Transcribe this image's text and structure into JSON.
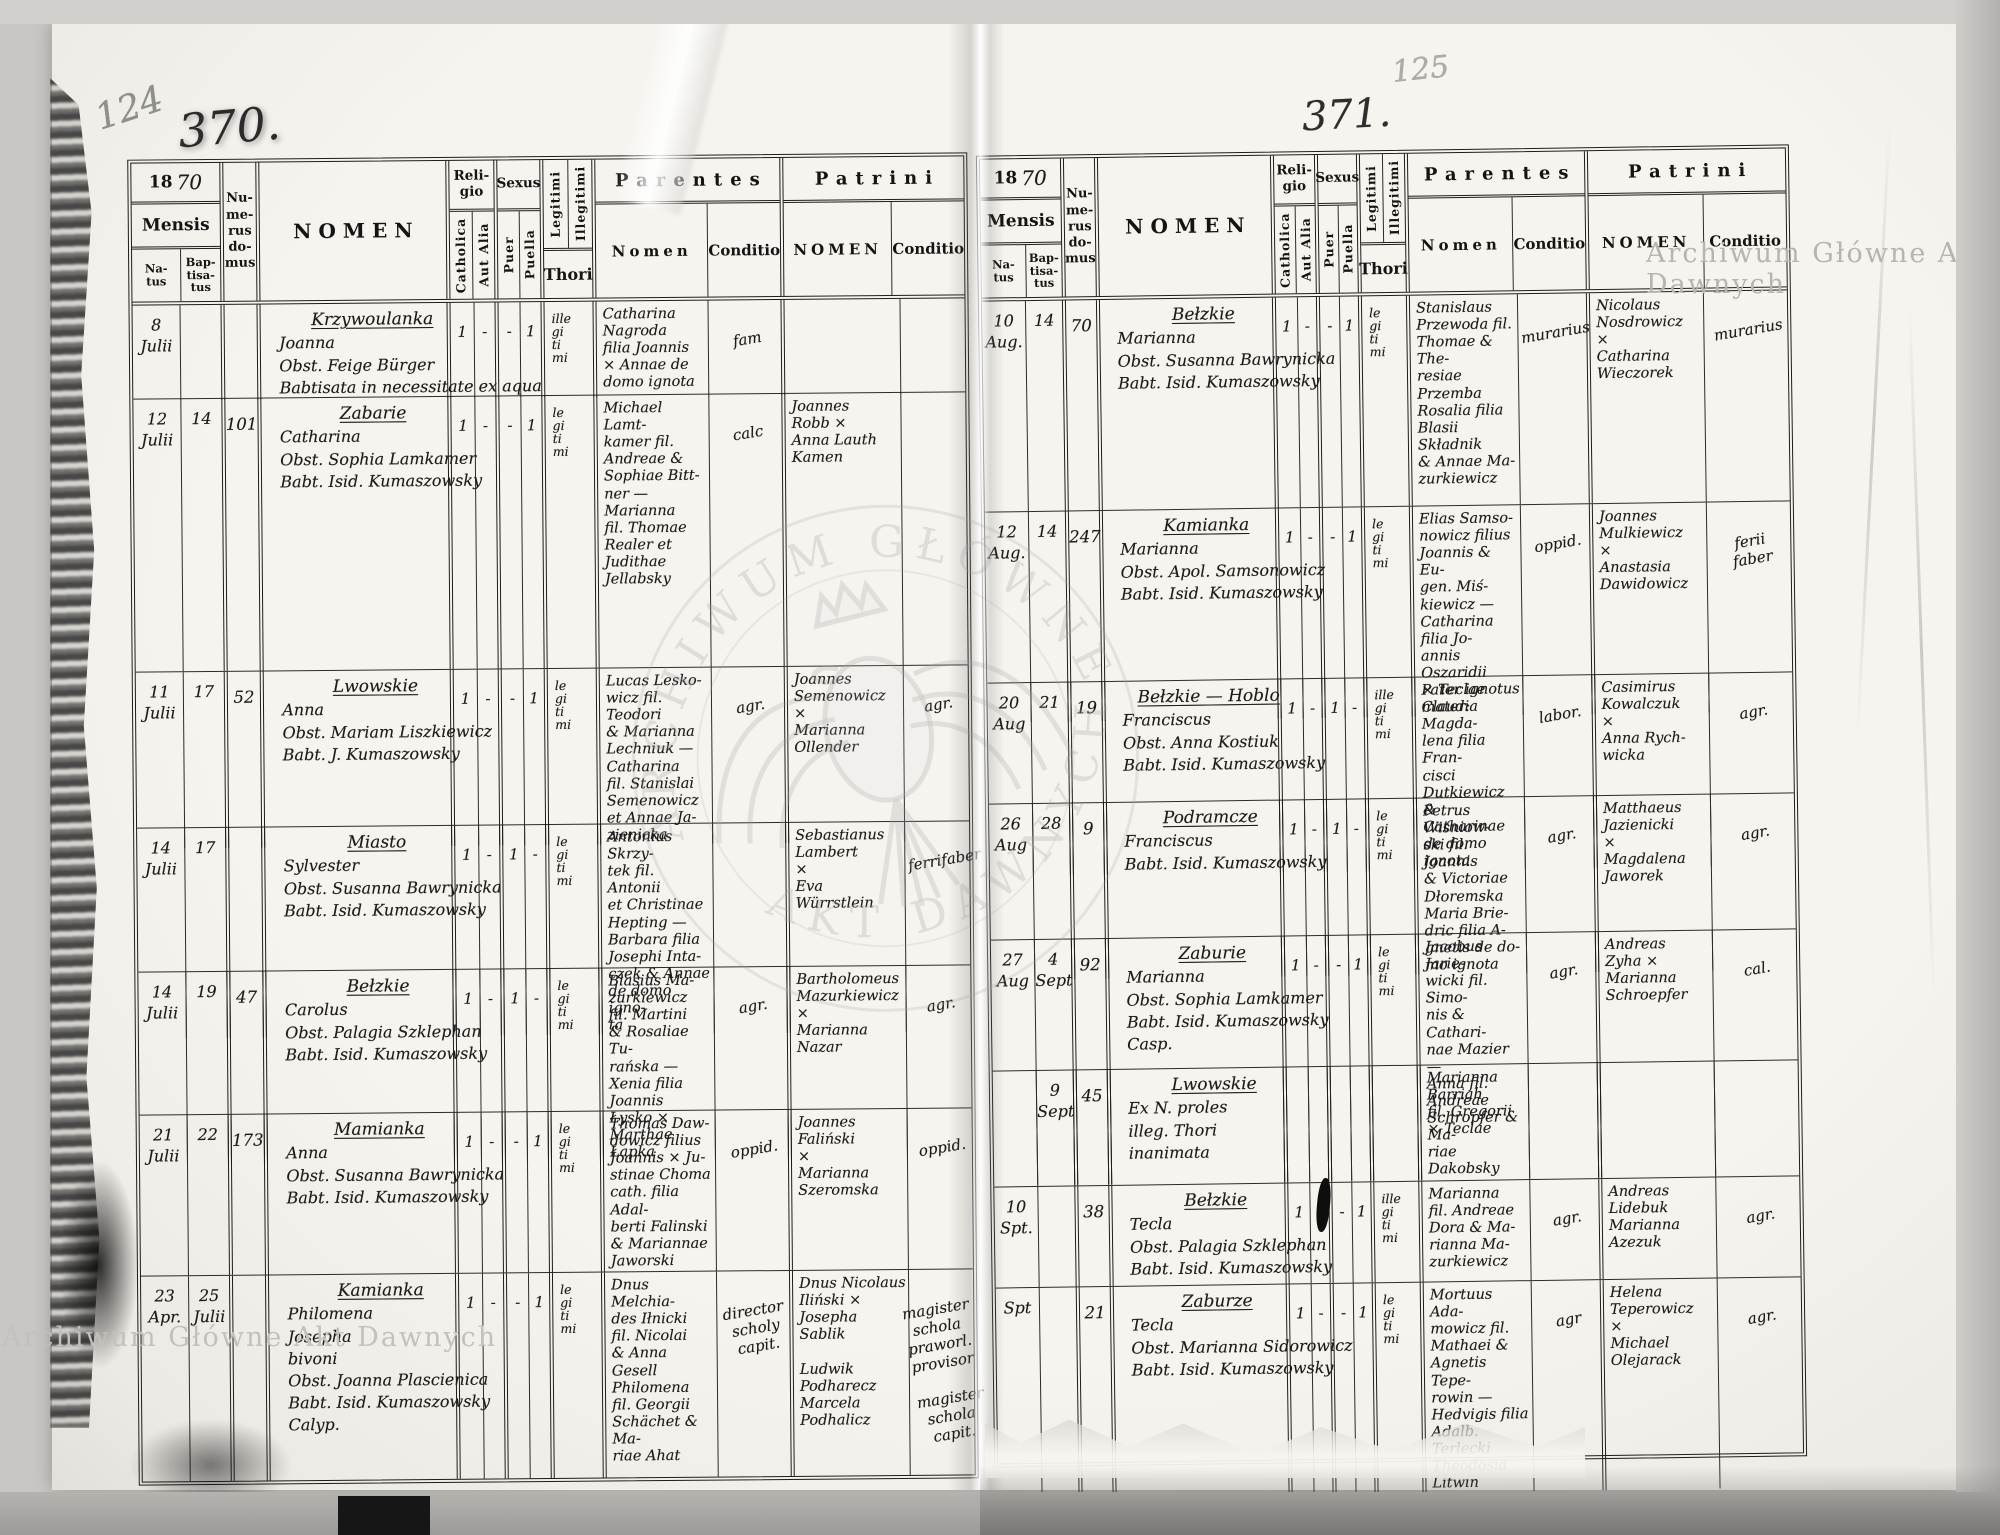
{
  "scan": {
    "watermark_top_right": "Archiwum Główne Akt Dawnych",
    "watermark_bottom_left": "Archiwum Główne Akt Dawnych",
    "stamp_arc_top": "ARCHIWUM GŁÓWNE",
    "stamp_arc_bottom": "AKT DAWNYCH",
    "pencil_folio_left": "124",
    "pencil_folio_right": "125",
    "page_number_left": "370.",
    "page_number_right": "371."
  },
  "header_labels": {
    "year_printed": "18",
    "year_hw": "70",
    "mensis": "Mensis",
    "natus": "Na-\ntus",
    "baptisatus": "Bap-\ntisa-\ntus",
    "numerus": "Nu-\nme-\nrus\ndo-\nmus",
    "nomen": "NOMEN",
    "religio": "Reli-\ngio",
    "catholica": "Catholica",
    "aut_alia": "Aut Alia",
    "sexus": "Sexus",
    "puer": "Puer",
    "puella": "Puella",
    "legitimi": "Legitimi",
    "illegitimi": "Illegitimi",
    "thori": "Thori",
    "parentes": "Parentes",
    "parentes_nomen": "Nomen",
    "parentes_conditio": "Conditio",
    "patrini": "Patrini",
    "patrini_nomen": "NOMEN",
    "patrini_conditio": "Conditio"
  },
  "left_page": {
    "rows": [
      {
        "natus": "8\nJulii",
        "baptisatus": "",
        "numerus": "",
        "nomen": [
          "Krzywoulanka",
          "Joanna",
          "Obst. Feige Bürger",
          "Babtisata in necessitate ex aqua"
        ],
        "catholica": "1",
        "aut_alia": "-",
        "puer": "-",
        "puella": "1",
        "thori": "ille\ngi\nti\nmi",
        "par_nomen": "Catharina\nNagroda\nfilia Joannis\n× Annae de\ndomo ignota",
        "par_conditio": "fam",
        "pat_nomen": "",
        "pat_conditio": ""
      },
      {
        "natus": "12\nJulii",
        "baptisatus": "14",
        "numerus": "101",
        "nomen": [
          "Zabarie",
          "Catharina",
          "Obst. Sophia Lamkamer",
          "Babt. Isid. Kumaszowsky"
        ],
        "catholica": "1",
        "aut_alia": "-",
        "puer": "-",
        "puella": "1",
        "thori": "le\ngi\nti\nmi",
        "par_nomen": "Michael Lamt-\nkamer fil.\nAndreae &\nSophiae Bitt-\nner —\nMarianna\nfil. Thomae\nRealer et\nJudithae\nJellabsky",
        "par_conditio": "calc",
        "pat_nomen": "Joannes\nRobb ×\nAnna Lauth\nKamen",
        "pat_conditio": ""
      },
      {
        "natus": "11\nJulii",
        "baptisatus": "17",
        "numerus": "52",
        "nomen": [
          "Lwowskie",
          "Anna",
          "Obst. Mariam Liszkiewicz",
          "Babt. J. Kumaszowsky"
        ],
        "catholica": "1",
        "aut_alia": "-",
        "puer": "-",
        "puella": "1",
        "thori": "le\ngi\nti\nmi",
        "par_nomen": "Lucas Lesko-\nwicz fil. Teodori\n& Marianna\nLechniuk —\nCatharina\nfil. Stanislai\nSemenowicz\net Annae Ja-\nzienicka",
        "par_conditio": "agr.",
        "pat_nomen": "Joannes\nSemenowicz\n×\nMarianna\nOllender",
        "pat_conditio": "agr."
      },
      {
        "natus": "14\nJulii",
        "baptisatus": "17",
        "numerus": "",
        "nomen": [
          "Miasto",
          "Sylvester",
          "Obst. Susanna Bawrynicka",
          "Babt. Isid. Kumaszowsky"
        ],
        "catholica": "1",
        "aut_alia": "-",
        "puer": "1",
        "puella": "-",
        "thori": "le\ngi\nti\nmi",
        "par_nomen": "Antonius Skrzy-\ntek fil. Antonii\net Christinae\nHepting —\nBarbara filia\nJosephi Inta-\nczek & Annae\nde domo igno-\nta",
        "par_conditio": "",
        "pat_nomen": "Sebastianus\nLambert\n×\nEva Würrstlein",
        "pat_conditio": "ferrifaber"
      },
      {
        "natus": "14\nJulii",
        "baptisatus": "19",
        "numerus": "47",
        "nomen": [
          "Bełzkie",
          "Carolus",
          "Obst. Palagia Szklephan",
          "Babt. Isid. Kumaszowsky"
        ],
        "catholica": "1",
        "aut_alia": "-",
        "puer": "1",
        "puella": "-",
        "thori": "le\ngi\nti\nmi",
        "par_nomen": "Blasius Ma-\nzurkiewicz\nfil. Martini\n& Rosaliae Tu-\nrańska —\nXenia filia Joannis\nŁysko × Marthae\nŁapka",
        "par_conditio": "agr.",
        "pat_nomen": "Bartholomeus\nMazurkiewicz\n×\nMarianna\nNazar",
        "pat_conditio": "agr."
      },
      {
        "natus": "21\nJulii",
        "baptisatus": "22",
        "numerus": "173",
        "nomen": [
          "Mamianka",
          "Anna",
          "Obst. Susanna Bawrynicka",
          "Babt. Isid. Kumaszowsky"
        ],
        "catholica": "1",
        "aut_alia": "-",
        "puer": "-",
        "puella": "1",
        "thori": "le\ngi\nti\nmi",
        "par_nomen": "Thomas Daw-\ndowicz filius\nJoannis × Ju-\nstinae Choma\ncath. filia Adal-\nberti Falinski\n& Mariannae\nJaworski",
        "par_conditio": "oppid.",
        "pat_nomen": "Joannes\nFaliński\n×\nMarianna\nSzeromska",
        "pat_conditio": "oppid."
      },
      {
        "natus": "23\nApr.",
        "baptisatus": "25\nJulii",
        "numerus": "",
        "nomen": [
          "Kamianka",
          "Philomena",
          "Josepha",
          "bivoni",
          "Obst. Joanna Plascienica",
          "Babt. Isid. Kumaszowsky",
          "Calyp."
        ],
        "catholica": "1",
        "aut_alia": "-",
        "puer": "-",
        "puella": "1",
        "thori": "le\ngi\nti\nmi",
        "par_nomen": "Dnus Melchia-\ndes Iłnicki\nfil. Nicolai\n& Anna Gesell\nPhilomena\nfil. Georgii\nSchächet & Ma-\nriae Ahat",
        "par_conditio": "director\nscholy\ncapit.",
        "pat_nomen": "Dnus Nicolaus\nIliński ×\nJosepha Sablik\n\nLudwik\nPodharecz\nMarcela\nPodhalicz",
        "pat_conditio": "magister\nschola\npraworl.\nprovisor\n\nmagister\nschola\ncapit."
      }
    ]
  },
  "right_page": {
    "rows": [
      {
        "natus": "10\nAug.",
        "baptisatus": "14",
        "numerus": "70",
        "nomen": [
          "Bełzkie",
          "Marianna",
          "Obst. Susanna Bawrynicka",
          "Babt. Isid. Kumaszowsky"
        ],
        "catholica": "1",
        "aut_alia": "-",
        "puer": "-",
        "puella": "1",
        "thori": "le\ngi\nti\nmi",
        "par_nomen": "Stanislaus\nPrzewoda fil.\nThomae & The-\nresiae Przemba\nRosalia filia\nBlasii Składnik\n& Annae Ma-\nzurkiewicz",
        "par_conditio": "murarius",
        "pat_nomen": "Nicolaus\nNosdrowicz\n×\nCatharina\nWieczorek",
        "pat_conditio": "murarius"
      },
      {
        "natus": "12\nAug.",
        "baptisatus": "14",
        "numerus": "247",
        "nomen": [
          "Kamianka",
          "Marianna",
          "Obst. Apol. Samsonowicz",
          "Babt. Isid. Kumaszowsky"
        ],
        "catholica": "1",
        "aut_alia": "-",
        "puer": "-",
        "puella": "1",
        "thori": "le\ngi\nti\nmi",
        "par_nomen": "Elias Samso-\nnowicz filius\nJoannis & Eu-\ngen. Miś-\nkiewicz —\nCatharina\nfilia Jo-\nannis Oszaridii\n× Teclae Claudia",
        "par_conditio": "oppid.",
        "pat_nomen": "Joannes\nMulkiewicz\n×\nAnastasia\nDawidowicz",
        "pat_conditio": "ferii\nfaber"
      },
      {
        "natus": "20\nAug",
        "baptisatus": "21",
        "numerus": "19",
        "nomen": [
          "Bełzkie — Hoblo",
          "Franciscus",
          "Obst. Anna Kostiuk",
          "Babt. Isid. Kumaszowsky"
        ],
        "catholica": "1",
        "aut_alia": "-",
        "puer": "1",
        "puella": "-",
        "thori": "ille\ngi\nti\nmi",
        "par_nomen": "Pater ignotus\nmater: Magda-\nlena filia Fran-\ncisci Dutkiewicz\n& Catharinae\nde domo ignota",
        "par_conditio": "labor.",
        "pat_nomen": "Casimirus\nKowalczuk\n×\nAnna Rych-\nwicka",
        "pat_conditio": "agr."
      },
      {
        "natus": "26\nAug",
        "baptisatus": "28",
        "numerus": "9",
        "nomen": [
          "Podramcze",
          "Franciscus",
          "",
          "Babt. Isid. Kumaszowsky"
        ],
        "catholica": "1",
        "aut_alia": "-",
        "puer": "1",
        "puella": "-",
        "thori": "le\ngi\nti\nmi",
        "par_nomen": "Petrus Wiśniow-\nski fil. Joannis\n& Victoriae\nDłoremska\nMaria Brie-\ndric filia A-\ngnetis de do-\nmo ignota",
        "par_conditio": "agr.",
        "pat_nomen": "Matthaeus\nJazienicki\n×\nMagdalena\nJaworek",
        "pat_conditio": "agr."
      },
      {
        "natus": "27\nAug",
        "baptisatus": "4\nSept",
        "numerus": "92",
        "nomen": [
          "Zaburie",
          "Marianna",
          "Obst. Sophia Lamkamer",
          "Babt. Isid. Kumaszowsky",
          "Casp."
        ],
        "catholica": "1",
        "aut_alia": "-",
        "puer": "-",
        "puella": "1",
        "thori": "le\ngi\nti\nmi",
        "par_nomen": "Jacobus Jarie-\nwicki fil. Simo-\nnis & Cathari-\nnae Mazier —\nAnna fil. Andreae\nSchropfer & Ma-\nriae Dakobsky",
        "par_conditio": "agr.",
        "pat_nomen": "Andreas\nZyha ×\nMarianna\nSchroepfer",
        "pat_conditio": "cal."
      },
      {
        "natus": "",
        "baptisatus": "9\nSept",
        "numerus": "45",
        "nomen": [
          "Lwowskie",
          "Ex N. proles",
          "illeg. Thori",
          "inanimata"
        ],
        "catholica": "",
        "aut_alia": "",
        "puer": "",
        "puella": "",
        "thori": "",
        "par_nomen": "Marianna\nBarriah\nfil. Gregorii\n× Teclae",
        "par_conditio": "",
        "pat_nomen": "",
        "pat_conditio": ""
      },
      {
        "natus": "10\nSpt.",
        "baptisatus": "",
        "numerus": "38",
        "nomen": [
          "Bełzkie",
          "Tecla",
          "Obst. Palagia Szklephan",
          "Babt. Isid. Kumaszowsky"
        ],
        "catholica": "1",
        "aut_alia": "-",
        "puer": "-",
        "puella": "1",
        "thori": "ille\ngi\nti\nmi",
        "par_nomen": "Marianna\nfil. Andreae\nDora & Ma-\nrianna Ma-\nzurkiewicz",
        "par_conditio": "agr.",
        "pat_nomen": "Andreas\nLidebuk\nMarianna\nAzezuk",
        "pat_conditio": "agr."
      },
      {
        "natus": "Spt",
        "baptisatus": "",
        "numerus": "21",
        "nomen": [
          "Zaburze",
          "Tecla",
          "Obst. Marianna Sidorowicz",
          "Babt. Isid. Kumaszowsky"
        ],
        "catholica": "1",
        "aut_alia": "-",
        "puer": "-",
        "puella": "1",
        "thori": "le\ngi\nti\nmi",
        "par_nomen": "Mortuus Ada-\nmowicz fil.\nMathaei &\nAgnetis Tepe-\nrowin —\nHedvigis filia\nAdalb. Terlecki\nTheodosia\nLitwin",
        "par_conditio": "agr",
        "pat_nomen": "Helena\nTeperowicz\n×\nMichael\nOlejarack",
        "pat_conditio": "agr."
      }
    ]
  }
}
